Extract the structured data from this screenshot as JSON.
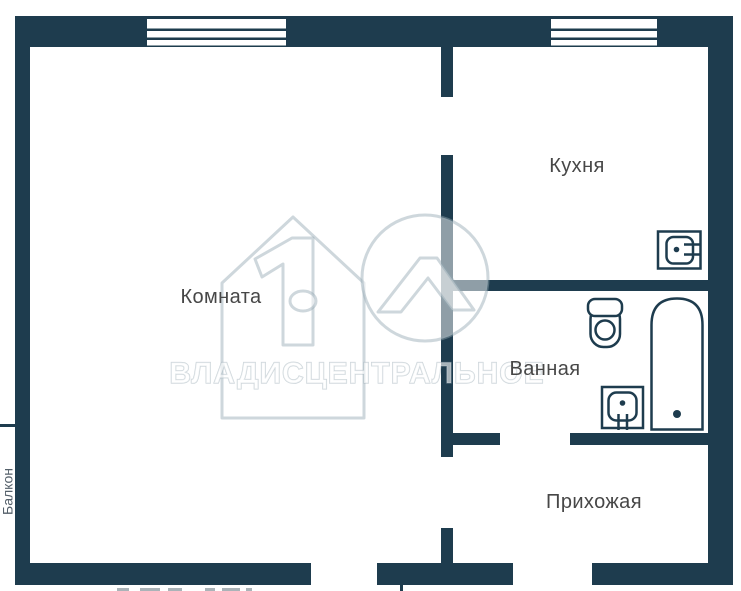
{
  "plan": {
    "rooms": {
      "room": {
        "label": "Комната"
      },
      "kitchen": {
        "label": "Кухня"
      },
      "bathroom": {
        "label": "Ванная"
      },
      "hallway": {
        "label": "Прихожая"
      },
      "balcony": {
        "label": "Балкон"
      }
    },
    "fixtures": {
      "kitchen_sink": "kitchen-sink-icon",
      "bathroom_sink": "bathroom-sink-icon",
      "toilet": "toilet-icon",
      "bathtub": "bathtub-icon",
      "windows": [
        "window-room",
        "window-kitchen"
      ]
    },
    "colors": {
      "wall": "#1e3c4e",
      "background": "#ffffff",
      "label": "#474747"
    },
    "watermark": {
      "text": "ВЛАДИСЦЕНТРАЛЬНОЕ"
    }
  }
}
